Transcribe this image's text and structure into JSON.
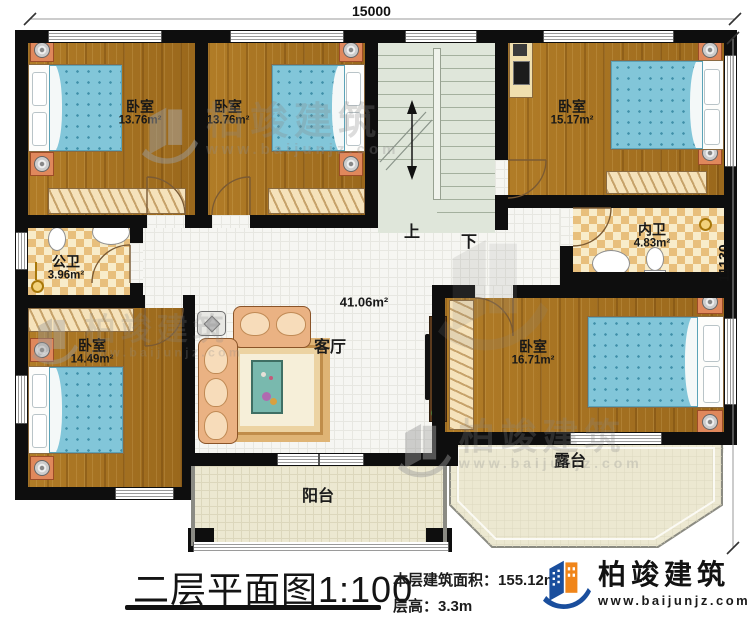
{
  "plan": {
    "dimensions": {
      "top": "15000",
      "right": "11130"
    },
    "stairs": {
      "up": "上",
      "down": "下"
    },
    "rooms": {
      "bedroom_top_left": {
        "label": "卧室",
        "area": "13.76m²"
      },
      "bedroom_top_mid": {
        "label": "卧室",
        "area": "13.76m²"
      },
      "bedroom_top_right": {
        "label": "卧室",
        "area": "15.17m²"
      },
      "public_bath": {
        "label": "公卫",
        "area": "3.96m²"
      },
      "private_bath": {
        "label": "内卫",
        "area": "4.83m²"
      },
      "bedroom_bottom_left": {
        "label": "卧室",
        "area": "14.49m²"
      },
      "bedroom_bottom_right": {
        "label": "卧室",
        "area": "16.71m²"
      },
      "living": {
        "label": "客厅",
        "area": "41.06m²"
      },
      "balcony": {
        "label": "阳台"
      },
      "terrace": {
        "label": "露台"
      }
    }
  },
  "titleblock": {
    "title": "二层平面图1:100",
    "area_label": "本层建筑面积：",
    "area_value": "155.12m²",
    "height_label": "层高：",
    "height_value": "3.3m"
  },
  "brand": {
    "name": "柏竣建筑",
    "website": "www.baijunjz.com"
  },
  "watermark": {
    "name": "柏竣建筑",
    "website": "www.baijunjz.com"
  },
  "colors": {
    "brand_blue": "#1a4e9d",
    "brand_orange": "#f08519",
    "bed_blue": "#82c6d9",
    "wood": "#a9751f"
  }
}
